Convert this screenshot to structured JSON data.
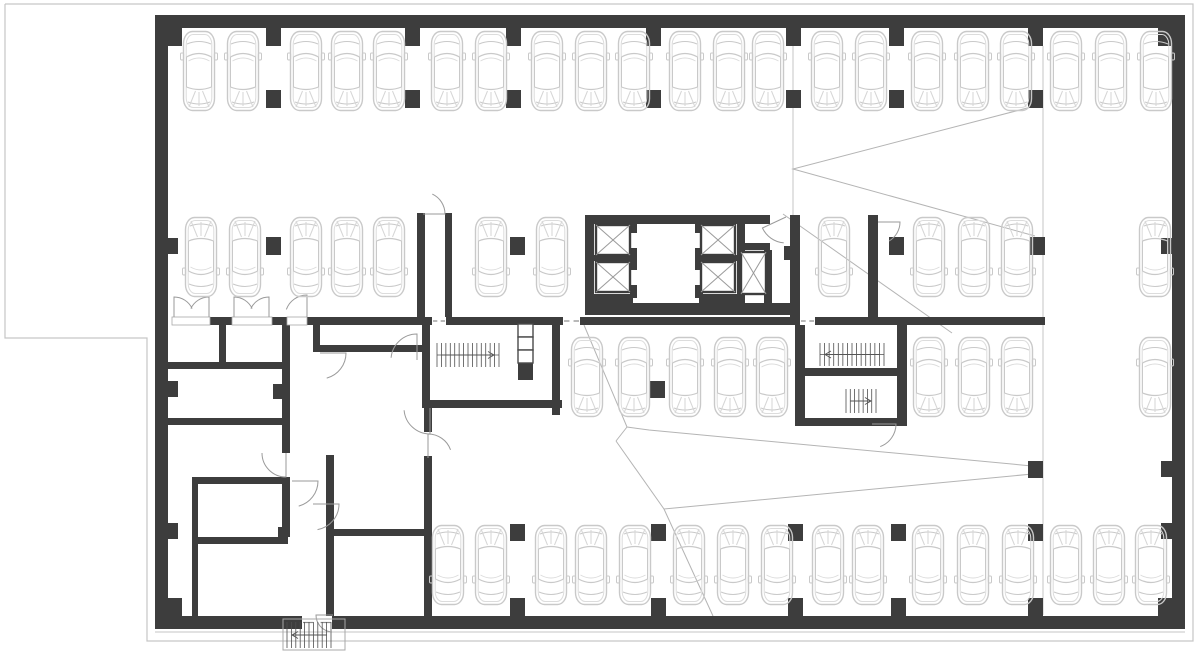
{
  "plan": {
    "width": 1200,
    "height": 654,
    "colors": {
      "wall": "#3d3d3d",
      "car": "#c9c9c9",
      "car_inner": "#dcdcdc",
      "thin": "#c6c6c6",
      "ramp": "#b4b4b4",
      "tread": "#4f4f4f",
      "arrow": "#555555",
      "door": "#9a9a9a",
      "elevator_x": "#9a9a9a",
      "duct": "#4a4a4a",
      "threshold": "#a8a8a8",
      "bg": "#ffffff"
    },
    "outline": [
      5,
      4,
      1193,
      4,
      1193,
      641,
      147,
      641,
      147,
      338,
      5,
      338,
      5,
      4
    ],
    "thin_lines": [
      [
        793,
        46,
        793,
        215
      ],
      [
        1043,
        46,
        1043,
        615
      ],
      [
        155,
        632,
        1185,
        632
      ]
    ],
    "ramp_lines": [
      [
        1035,
        106,
        793,
        169,
        1035,
        236
      ],
      [
        783,
        214,
        952,
        333
      ],
      [
        584,
        325,
        627,
        427,
        649,
        430,
        1043,
        467
      ],
      [
        627,
        427,
        616,
        441
      ],
      [
        616,
        441,
        664,
        509,
        1043,
        473
      ],
      [
        664,
        509,
        713,
        616
      ]
    ],
    "walls": [
      [
        155,
        15,
        1030,
        13
      ],
      [
        155,
        616,
        1030,
        13
      ],
      [
        155,
        15,
        13,
        614
      ],
      [
        1172,
        15,
        13,
        614
      ],
      [
        168,
        28,
        14,
        18
      ],
      [
        1158,
        28,
        14,
        18
      ],
      [
        168,
        598,
        14,
        18
      ],
      [
        1158,
        598,
        14,
        18
      ],
      [
        210,
        317,
        23,
        8
      ],
      [
        270,
        317,
        17,
        8
      ],
      [
        307,
        317,
        125,
        8
      ],
      [
        446,
        317,
        117,
        8
      ],
      [
        580,
        317,
        220,
        8
      ],
      [
        815,
        317,
        230,
        8
      ],
      [
        168,
        362,
        120,
        7
      ],
      [
        219,
        325,
        7,
        37
      ],
      [
        282,
        318,
        8,
        66
      ],
      [
        273,
        384,
        17,
        15
      ],
      [
        282,
        399,
        8,
        54
      ],
      [
        168,
        418,
        122,
        7
      ],
      [
        192,
        477,
        98,
        7
      ],
      [
        192,
        484,
        6,
        134
      ],
      [
        196,
        537,
        92,
        7
      ],
      [
        282,
        484,
        8,
        53
      ],
      [
        278,
        527,
        10,
        15
      ],
      [
        326,
        455,
        8,
        163
      ],
      [
        326,
        529,
        104,
        7
      ],
      [
        313,
        325,
        7,
        27
      ],
      [
        313,
        345,
        117,
        7
      ],
      [
        417,
        213,
        8,
        112
      ],
      [
        445,
        213,
        7,
        112
      ],
      [
        422,
        325,
        8,
        83
      ],
      [
        422,
        400,
        140,
        8
      ],
      [
        424,
        408,
        8,
        24
      ],
      [
        424,
        456,
        8,
        162
      ],
      [
        552,
        324,
        8,
        91
      ],
      [
        518,
        363,
        15,
        17
      ],
      [
        585,
        215,
        9,
        100
      ],
      [
        585,
        215,
        185,
        9
      ],
      [
        588,
        255,
        45,
        6
      ],
      [
        588,
        294,
        45,
        9
      ],
      [
        630,
        224,
        7,
        9
      ],
      [
        630,
        248,
        7,
        22
      ],
      [
        630,
        285,
        7,
        13
      ],
      [
        737,
        224,
        8,
        79
      ],
      [
        695,
        224,
        8,
        9
      ],
      [
        695,
        248,
        8,
        22
      ],
      [
        695,
        285,
        8,
        13
      ],
      [
        699,
        255,
        40,
        6
      ],
      [
        699,
        294,
        40,
        9
      ],
      [
        737,
        243,
        33,
        7
      ],
      [
        764,
        250,
        8,
        62
      ],
      [
        585,
        303,
        215,
        12
      ],
      [
        790,
        215,
        10,
        102
      ],
      [
        784,
        246,
        7,
        14
      ],
      [
        868,
        215,
        10,
        102
      ],
      [
        795,
        318,
        10,
        108
      ],
      [
        897,
        318,
        10,
        108
      ],
      [
        805,
        368,
        92,
        8
      ],
      [
        795,
        418,
        112,
        8
      ]
    ],
    "columns": [
      [
        266,
        28,
        15,
        18
      ],
      [
        405,
        28,
        15,
        18
      ],
      [
        506,
        28,
        15,
        18
      ],
      [
        646,
        28,
        15,
        18
      ],
      [
        786,
        28,
        15,
        18
      ],
      [
        889,
        28,
        15,
        18
      ],
      [
        1028,
        28,
        15,
        18
      ],
      [
        266,
        90,
        15,
        18
      ],
      [
        405,
        90,
        15,
        18
      ],
      [
        506,
        90,
        15,
        18
      ],
      [
        646,
        90,
        15,
        18
      ],
      [
        786,
        90,
        15,
        18
      ],
      [
        889,
        90,
        15,
        18
      ],
      [
        1028,
        90,
        15,
        18
      ],
      [
        266,
        237,
        15,
        18
      ],
      [
        510,
        237,
        15,
        18
      ],
      [
        889,
        237,
        15,
        18
      ],
      [
        1030,
        237,
        15,
        18
      ],
      [
        167,
        238,
        11,
        16
      ],
      [
        1161,
        238,
        11,
        16
      ],
      [
        650,
        381,
        15,
        17
      ],
      [
        167,
        381,
        11,
        16
      ],
      [
        1028,
        461,
        15,
        17
      ],
      [
        1161,
        461,
        11,
        16
      ],
      [
        510,
        524,
        15,
        17
      ],
      [
        651,
        524,
        15,
        17
      ],
      [
        788,
        524,
        15,
        17
      ],
      [
        891,
        524,
        15,
        17
      ],
      [
        1028,
        524,
        15,
        17
      ],
      [
        167,
        523,
        11,
        16
      ],
      [
        1161,
        523,
        11,
        16
      ],
      [
        510,
        598,
        15,
        18
      ],
      [
        651,
        598,
        15,
        18
      ],
      [
        788,
        598,
        15,
        18
      ],
      [
        891,
        598,
        15,
        18
      ],
      [
        1028,
        598,
        15,
        18
      ],
      [
        167,
        598,
        11,
        16
      ]
    ],
    "ducts": [
      [
        518,
        324,
        15,
        13
      ],
      [
        518,
        337,
        15,
        13
      ],
      [
        518,
        350,
        15,
        13
      ]
    ],
    "elevators": [
      [
        596,
        225,
        34,
        30
      ],
      [
        596,
        262,
        34,
        30
      ],
      [
        701,
        225,
        34,
        30
      ],
      [
        701,
        262,
        34,
        30
      ],
      [
        741,
        252,
        25,
        42
      ]
    ],
    "thresholds": [
      [
        172,
        317,
        38,
        8
      ],
      [
        232,
        317,
        40,
        8
      ],
      [
        287,
        317,
        20,
        8
      ]
    ],
    "dash_gaps": [
      [
        432,
        317,
        14,
        8
      ],
      [
        563,
        317,
        17,
        8
      ],
      [
        800,
        317,
        15,
        8
      ],
      [
        302,
        616,
        30,
        13
      ]
    ],
    "doors": [
      [
        174,
        317,
        20,
        -90,
        -25
      ],
      [
        209,
        317,
        20,
        -90,
        -155
      ],
      [
        234,
        317,
        20,
        -90,
        -25
      ],
      [
        269,
        317,
        20,
        -90,
        -155
      ],
      [
        307,
        317,
        22,
        -90,
        -160
      ],
      [
        423,
        214,
        22,
        0,
        -65
      ],
      [
        786,
        217,
        26,
        155,
        95
      ],
      [
        878,
        222,
        22,
        0,
        60
      ],
      [
        872,
        424,
        24,
        0,
        70
      ],
      [
        417,
        360,
        26,
        -90,
        -175
      ],
      [
        430,
        408,
        26,
        90,
        175
      ],
      [
        428,
        458,
        24,
        -90,
        -20
      ],
      [
        286,
        453,
        24,
        90,
        180
      ],
      [
        292,
        481,
        26,
        0,
        75
      ],
      [
        313,
        504,
        26,
        0,
        80
      ],
      [
        320,
        353,
        26,
        0,
        75
      ],
      [
        333,
        615,
        17,
        180,
        100
      ]
    ],
    "stairs": [
      {
        "x": 437,
        "y": 343,
        "w": 62,
        "h": 24,
        "n": 14,
        "arrow": "right",
        "mid": true
      },
      {
        "x": 820,
        "y": 343,
        "w": 64,
        "h": 23,
        "n": 14,
        "arrow": "left",
        "mid": true
      },
      {
        "x": 846,
        "y": 389,
        "w": 30,
        "h": 24,
        "n": 7,
        "arrow": "right",
        "mid": false
      },
      {
        "x": 287,
        "y": 622,
        "w": 44,
        "h": 26,
        "n": 10,
        "arrow": "left",
        "mid": false
      }
    ],
    "thin_boxes": [
      [
        283,
        619,
        62,
        31
      ]
    ],
    "cars": {
      "size": {
        "w": 34,
        "h": 82
      },
      "rows": [
        {
          "y": 30,
          "rot": 0,
          "centers": [
            199,
            243,
            306,
            347,
            389,
            447,
            491,
            547,
            591,
            634,
            685,
            729,
            768,
            827,
            871,
            927,
            973,
            1016,
            1066,
            1111,
            1156
          ]
        },
        {
          "y": 216,
          "rot": 180,
          "centers": [
            201,
            245,
            306,
            347,
            389,
            491,
            552,
            834,
            929,
            974,
            1017,
            1155
          ]
        },
        {
          "y": 336,
          "rot": 0,
          "centers": [
            587,
            634,
            685,
            730,
            772,
            929,
            974,
            1017,
            1155
          ]
        },
        {
          "y": 524,
          "rot": 180,
          "centers": [
            448,
            491,
            551,
            591,
            635,
            689,
            733,
            777,
            828,
            868,
            928,
            973,
            1018,
            1066,
            1109,
            1151
          ]
        }
      ]
    }
  }
}
